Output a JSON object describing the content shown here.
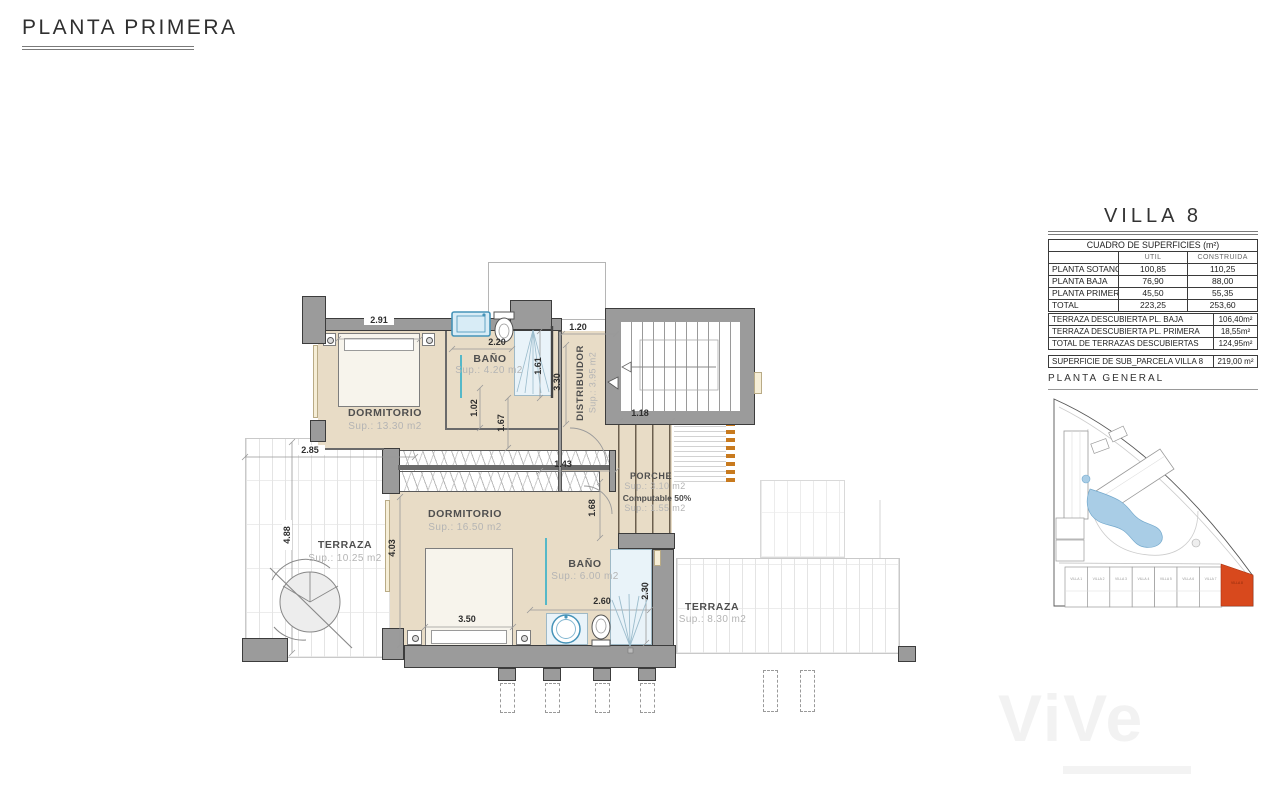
{
  "page": {
    "title": "PLANTA PRIMERA"
  },
  "panel": {
    "title": "VILLA 8",
    "surfaces_table": {
      "title": "CUADRO DE SUPERFICIES (m²)",
      "col_util": "UTIL",
      "col_construida": "CONSTRUIDA",
      "rows": [
        {
          "label": "PLANTA SOTANO",
          "util": "100,85",
          "construida": "110,25"
        },
        {
          "label": "PLANTA BAJA",
          "util": "76,90",
          "construida": "88,00"
        },
        {
          "label": "PLANTA PRIMERA",
          "util": "45,50",
          "construida": "55,35"
        },
        {
          "label": "TOTAL",
          "util": "223,25",
          "construida": "253,60"
        }
      ]
    },
    "terraces_table": {
      "rows": [
        {
          "label": "TERRAZA DESCUBIERTA PL. BAJA",
          "value": "106,40m²"
        },
        {
          "label": "TERRAZA DESCUBIERTA PL. PRIMERA",
          "value": "18,55m²"
        },
        {
          "label": "TOTAL DE TERRAZAS DESCUBIERTAS",
          "value": "124,95m²"
        }
      ]
    },
    "parcel_row": {
      "label": "SUPERFICIE DE SUB_PARCELA VILLA 8",
      "value": "219,00 m²"
    },
    "siteplan_title": "PLANTA GENERAL",
    "siteplan": {
      "villas": [
        "VILLA 1",
        "VILLA 2",
        "VILLA 3",
        "VILLA 4",
        "VILLA 5",
        "VILLA 6",
        "VILLA 7",
        "VILLA 8"
      ]
    }
  },
  "plan": {
    "rooms": {
      "dorm1": {
        "name": "DORMITORIO",
        "sup": "Sup.: 13.30  m2"
      },
      "bath1": {
        "name": "BAÑO",
        "sup": "Sup.: 4.20    m2"
      },
      "dist": {
        "name": "DISTRIBUIDOR",
        "sup": "Sup.: 3.95  m2"
      },
      "dorm2": {
        "name": "DORMITORIO",
        "sup": "Sup.: 16.50  m2"
      },
      "bath2": {
        "name": "BAÑO",
        "sup": "Sup.: 6.00   m2"
      },
      "terr1": {
        "name": "TERRAZA",
        "sup": "Sup.: 10.25  m2"
      },
      "terr2": {
        "name": "TERRAZA",
        "sup": "Sup.:  8.30    m2"
      },
      "porch": {
        "name": "PORCHE",
        "sup1": "Sup.: 3.10    m2",
        "note": "Computable 50%",
        "sup2": "Sup.: 1.55    m2"
      }
    },
    "dims": {
      "bed1_w": "2.91",
      "bath1_w": "2.20",
      "bath1_h": "1.61",
      "hall_w": "1.20",
      "dist_h": "3.30",
      "d102": "1.02",
      "d167": "1.67",
      "terr1_w": "2.85",
      "terr1_h": "4.88",
      "d143": "1.43",
      "d118": "1.18",
      "d168": "1.68",
      "dorm2_h": "4.03",
      "bed2_w": "3.50",
      "bath2_w": "2.60",
      "bath2_h": "2.30"
    }
  },
  "watermark": {
    "text": "ViVe"
  },
  "colors": {
    "accent_villa8": "#d8491d",
    "room_fill": "#e8dcc6",
    "wall": "#9b9b9b",
    "pool": "#a9cde6",
    "fixture": "#4593b8",
    "porch_edge": "#c87a1e"
  }
}
